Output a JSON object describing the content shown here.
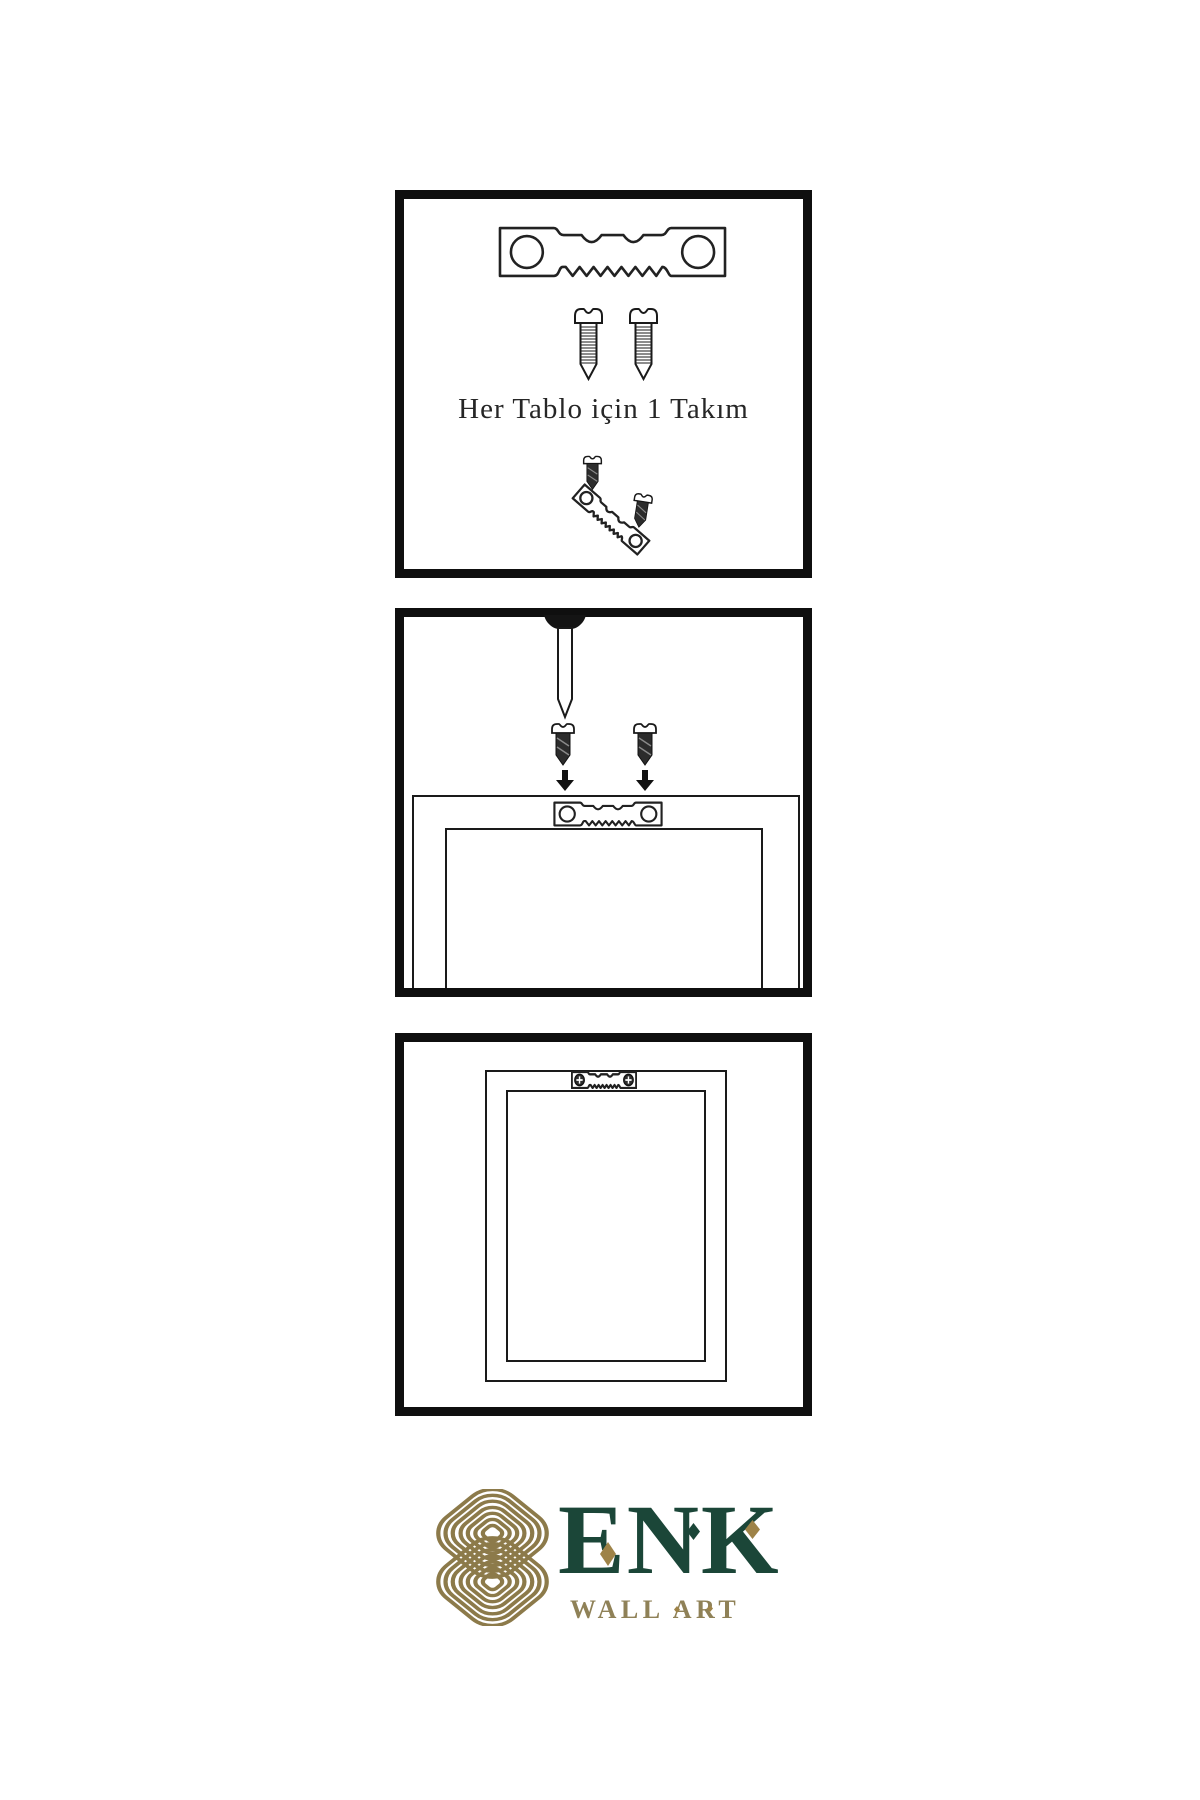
{
  "background": "#ffffff",
  "line_color": "#1a1a1a",
  "panel1": {
    "caption": "Her Tablo için 1 Takım"
  },
  "logo": {
    "name": "ENK",
    "subtitle": "WALL ART",
    "colors": {
      "green": "#1b4638",
      "knot_gold": "#8c7a4a",
      "accent_gold": "#9e8348",
      "subtitle_gold": "#8f8157"
    }
  }
}
